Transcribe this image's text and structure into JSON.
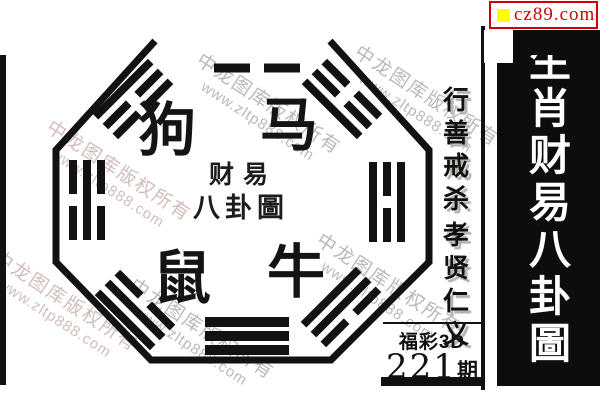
{
  "poster": {
    "site_badge": {
      "label": "cz89.com",
      "accent_color": "#d40000",
      "square_color": "#ffff00"
    },
    "sidebar_title": {
      "text": "生肖财易八卦圖",
      "chars": [
        "生",
        "肖",
        "财",
        "易",
        "八",
        "卦",
        "圖"
      ]
    },
    "seal": {
      "line1": "财易",
      "line2": "八卦圖"
    },
    "zodiac": [
      {
        "char": "狗",
        "x": 167,
        "y": 131
      },
      {
        "char": "马",
        "x": 289,
        "y": 126
      },
      {
        "char": "鼠",
        "x": 182,
        "y": 279
      },
      {
        "char": "牛",
        "x": 296,
        "y": 273
      }
    ],
    "motto": {
      "col1": "行善戒杀",
      "col2": "孝贤仁义"
    },
    "issue": {
      "game": "福彩3D",
      "number": "221",
      "suffix": "期"
    },
    "trigrams": [
      {
        "pos": "top-kun-partial",
        "lines": [
          "broken"
        ],
        "cx": 257,
        "cy": 68,
        "angle": 0,
        "len": 86,
        "th": 9,
        "gap": 5
      },
      {
        "pos": "top-left-gen",
        "lines": [
          "solid",
          "broken",
          "broken"
        ],
        "cx": 133,
        "cy": 99,
        "angle": -45,
        "len": 78,
        "th": 8,
        "gap": 6
      },
      {
        "pos": "top-right-zhen",
        "lines": [
          "broken",
          "broken",
          "solid"
        ],
        "cx": 342,
        "cy": 99,
        "angle": 45,
        "len": 78,
        "th": 8,
        "gap": 6
      },
      {
        "pos": "left-kan",
        "lines": [
          "broken",
          "solid",
          "broken"
        ],
        "cx": 87,
        "cy": 200,
        "angle": -90,
        "len": 80,
        "th": 8,
        "gap": 6
      },
      {
        "pos": "right-li",
        "lines": [
          "solid",
          "broken",
          "solid"
        ],
        "cx": 387,
        "cy": 202,
        "angle": 90,
        "len": 80,
        "th": 8,
        "gap": 6
      },
      {
        "pos": "bottom-qian",
        "lines": [
          "solid",
          "solid",
          "solid"
        ],
        "cx": 247,
        "cy": 336,
        "angle": 180,
        "len": 84,
        "th": 10,
        "gap": 4
      },
      {
        "pos": "bottom-left-xun",
        "lines": [
          "solid",
          "solid",
          "broken"
        ],
        "cx": 135,
        "cy": 310,
        "angle": -135,
        "len": 78,
        "th": 8,
        "gap": 6
      },
      {
        "pos": "bottom-right-dui",
        "lines": [
          "broken",
          "solid",
          "solid"
        ],
        "cx": 341,
        "cy": 307,
        "angle": 135,
        "len": 78,
        "th": 8,
        "gap": 6
      }
    ],
    "watermark": {
      "line1": "中龙图库版权所有",
      "line2": "www.zltp888.com",
      "color": "rgba(146,140,136,0.62)",
      "tint_color": "rgba(172,134,130,0.55)",
      "instances": [
        {
          "x": 115,
          "y": 175,
          "tint": true
        },
        {
          "x": 265,
          "y": 108,
          "tint": false
        },
        {
          "x": 423,
          "y": 100,
          "tint": false
        },
        {
          "x": 385,
          "y": 288,
          "tint": false
        },
        {
          "x": 198,
          "y": 333,
          "tint": false
        },
        {
          "x": 62,
          "y": 305,
          "tint": true
        }
      ]
    }
  }
}
